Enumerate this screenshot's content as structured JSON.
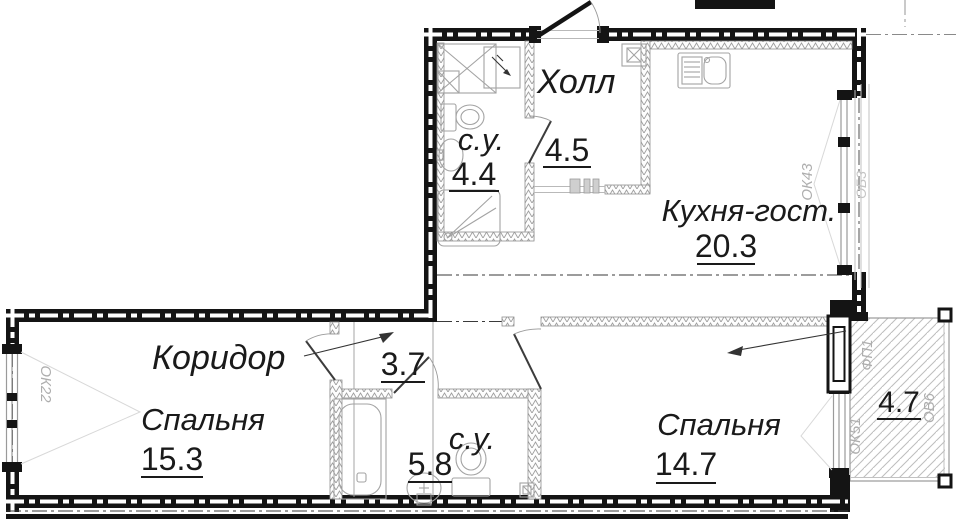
{
  "rooms": {
    "hall": {
      "name": "Холл",
      "area": "4.5"
    },
    "wc_top": {
      "name": "с.у.",
      "area": "4.4"
    },
    "kitchen": {
      "name": "Кухня-гост.",
      "area": "20.3"
    },
    "corridor": {
      "name": "Коридор",
      "area": "3.7"
    },
    "bedroom_left": {
      "name": "Спальня",
      "area": "15.3"
    },
    "wc_bottom": {
      "name": "с.у.",
      "area": "5.8"
    },
    "bedroom_right": {
      "name": "Спальня",
      "area": "14.7"
    },
    "balcony": {
      "area": "4.7"
    }
  },
  "marks": {
    "window_left": "ОК22",
    "window_kitchen": "ОК43",
    "glazing_outer": "ОБ3",
    "balcony_door": "ФП1",
    "balcony_window": "ОК51",
    "balcony_glazing": "ОВ6"
  },
  "colors": {
    "wall": "#141414",
    "mark_gray": "#aeaeae",
    "fixture_gray": "#a3a3a3"
  }
}
